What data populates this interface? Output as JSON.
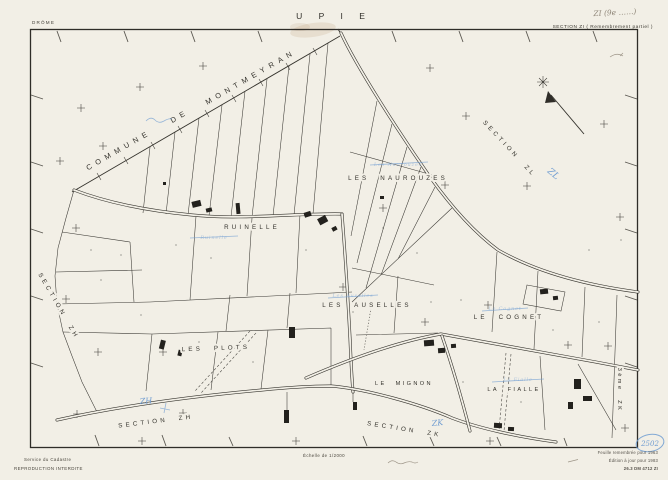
{
  "header": {
    "department": "DRÔME",
    "title": "U P I E",
    "section": "SECTION ZI  ( Remembrement partiel )",
    "pencil_note": "ZI (9e ……)"
  },
  "footer": {
    "service": "Service du Cadastre",
    "notice": "REPRODUCTION INTERDITE",
    "scale": "Échelle de 1/2000",
    "edition_lines": [
      "Feuille remembrée pour 1963",
      "Édition à jour pour 1983",
      "26.3 DM 4712   ZI"
    ],
    "blue_reference": "2502"
  },
  "map": {
    "neighbor_commune": {
      "line1": "COMMUNE",
      "line2": "DE",
      "line3": "MONTMEYRAN"
    },
    "sections": {
      "zl": "SECTION  ZL",
      "zh_west": "SECTION  ZH",
      "zh_south": "SECTION  ZH",
      "zk_south": "SECTION  ZK",
      "zk_east": "3ème  ZK"
    },
    "lieux_dits": {
      "naurouzes": "LES  NAUROUZES",
      "ruinelle": "RUINELLE",
      "auselles": "LES  AUSELLES",
      "cognet": "LE  COGNET",
      "plots": "LES  PLOTS",
      "mignon": "LE  MIGNON",
      "fialle": "LA  FIALLE"
    },
    "blue_notes": {
      "zl": "ZL",
      "zh": "ZH",
      "zk": "ZK",
      "ruinelle": "Ruinelle",
      "naurouzes": "Les Naurouzes",
      "auselles": "Les Auselles",
      "cognet": "Le Cognet",
      "fialle": "La Fialle"
    }
  },
  "colors": {
    "paper": "#f2efe6",
    "ink": "#2f2d28",
    "blue_pen": "#6f9cd1",
    "pencil": "#8e8577"
  }
}
